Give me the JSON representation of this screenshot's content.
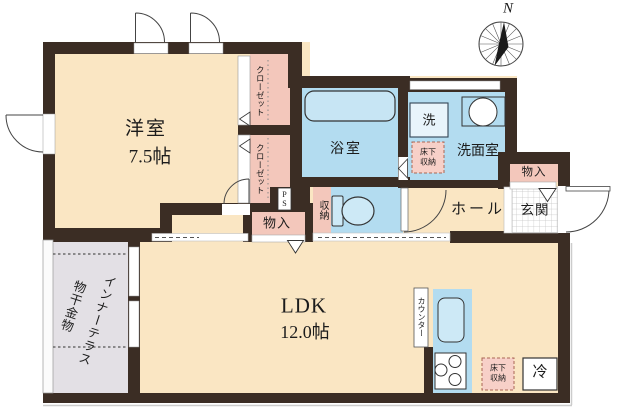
{
  "plan": {
    "title": "apartment-floor-plan",
    "compass": {
      "north_label": "N"
    },
    "rooms": {
      "western_room": {
        "name": "洋室",
        "size": "7.5帖"
      },
      "ldk": {
        "name": "LDK",
        "size": "12.0帖"
      },
      "bathroom": {
        "name": "浴室"
      },
      "washroom": {
        "name": "洗面室"
      },
      "washer": {
        "name": "洗"
      },
      "hall": {
        "name": "ホール"
      },
      "entrance": {
        "name": "玄関"
      },
      "inner_terrace": {
        "name": "インナーテラス",
        "sub": "物干金物"
      },
      "closet_top": {
        "name": "クローゼット"
      },
      "closet_bottom": {
        "name": "クローゼット"
      },
      "storage_right": {
        "name": "物入"
      },
      "storage_middle": {
        "name": "物入"
      },
      "storage_toilet": {
        "name": "収納"
      },
      "pipe_space": {
        "name": "PS"
      },
      "counter": {
        "name": "カウンター"
      },
      "fridge": {
        "name": "冷"
      },
      "underfloor_washroom": {
        "name": "床下収納"
      },
      "underfloor_kitchen": {
        "name": "床下収納"
      }
    },
    "colors": {
      "wall": "#3b2d24",
      "floor_cream": "#fae6c3",
      "wet_area_blue": "#b3dcf0",
      "closet_pink": "#f3c7bb",
      "underfloor_pink": "#f7d0c8",
      "terrace_gray": "#e3e0e5",
      "fixture_white": "#ffffff"
    }
  }
}
